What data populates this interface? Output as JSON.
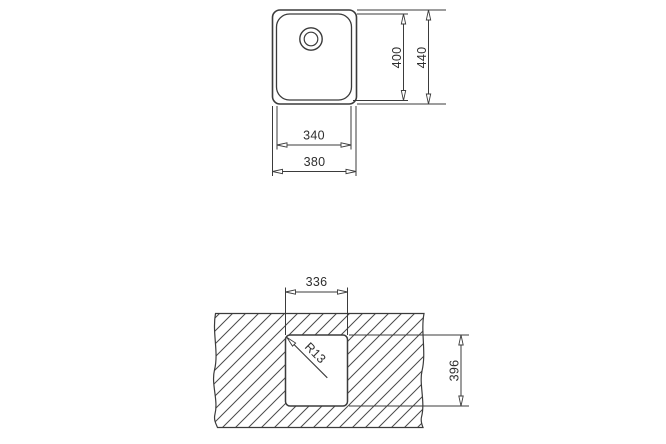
{
  "style": {
    "line_color": "#3b3b3b",
    "hatch_color": "#4a4a4a",
    "text_color": "#2e2e2e",
    "background": "#ffffff"
  },
  "top_view": {
    "name": "sink top view",
    "dims": {
      "bowl_width": "340",
      "overall_width": "380",
      "bowl_depth": "400",
      "overall_depth": "440"
    }
  },
  "cutout_view": {
    "name": "countertop cutout view",
    "dims": {
      "cutout_width": "336",
      "cutout_depth": "396",
      "corner_radius": "R13"
    }
  }
}
